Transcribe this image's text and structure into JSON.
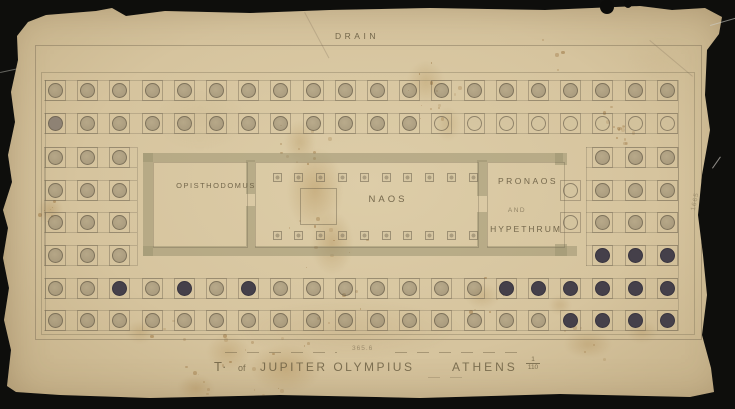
{
  "drawing": {
    "drain_label": "DRAIN",
    "rooms": {
      "opisthodomus": "OPISTHODOMUS",
      "naos": "NAOS",
      "pronaos": "PRONAOS",
      "pronaos_and": "AND",
      "pronaos_hypethrum": "HYPETHRUM"
    },
    "side_note": "1665",
    "title_block": {
      "figure_note": "365.6",
      "title_t": "T·",
      "title_of": "of",
      "title_main": "JUPITER OLYMPIUS",
      "title_city": "ATHENS",
      "scale_num": "1",
      "scale_den": "110"
    }
  },
  "colors": {
    "photo_background": "#0e0e0c",
    "paper": "#d6c49e",
    "ink": "#6e6450",
    "wall_wash": "#9c9371",
    "column_dark": "#45404a"
  },
  "plan_geometry": {
    "col_x_start": 55.5,
    "col_dx": 32.2,
    "col_count": 20,
    "row_ys": [
      90,
      123,
      157,
      190,
      222,
      255,
      288,
      320
    ],
    "full_rows": [
      0,
      1,
      6,
      7
    ],
    "end_left": [
      0,
      1,
      2
    ],
    "end_right": [
      17,
      18,
      19
    ],
    "extra": [
      [
        3,
        16
      ],
      [
        4,
        16
      ]
    ],
    "light": [
      [
        3,
        16
      ],
      [
        4,
        16
      ],
      [
        1,
        12
      ],
      [
        1,
        13
      ],
      [
        1,
        14
      ],
      [
        1,
        15
      ],
      [
        1,
        16
      ],
      [
        1,
        17
      ],
      [
        1,
        18
      ],
      [
        1,
        19
      ]
    ],
    "medium": [
      [
        1,
        0
      ]
    ],
    "dark": [
      [
        5,
        17
      ],
      [
        5,
        18
      ],
      [
        5,
        19
      ],
      [
        6,
        2
      ],
      [
        6,
        4
      ],
      [
        6,
        6
      ],
      [
        6,
        14
      ],
      [
        6,
        15
      ],
      [
        6,
        16
      ],
      [
        6,
        17
      ],
      [
        6,
        18
      ],
      [
        6,
        19
      ],
      [
        7,
        16
      ],
      [
        7,
        17
      ],
      [
        7,
        18
      ],
      [
        7,
        19
      ]
    ],
    "piers": {
      "x_start": 277,
      "dx": 21.8,
      "count": 10,
      "ys": [
        177,
        235
      ]
    }
  }
}
